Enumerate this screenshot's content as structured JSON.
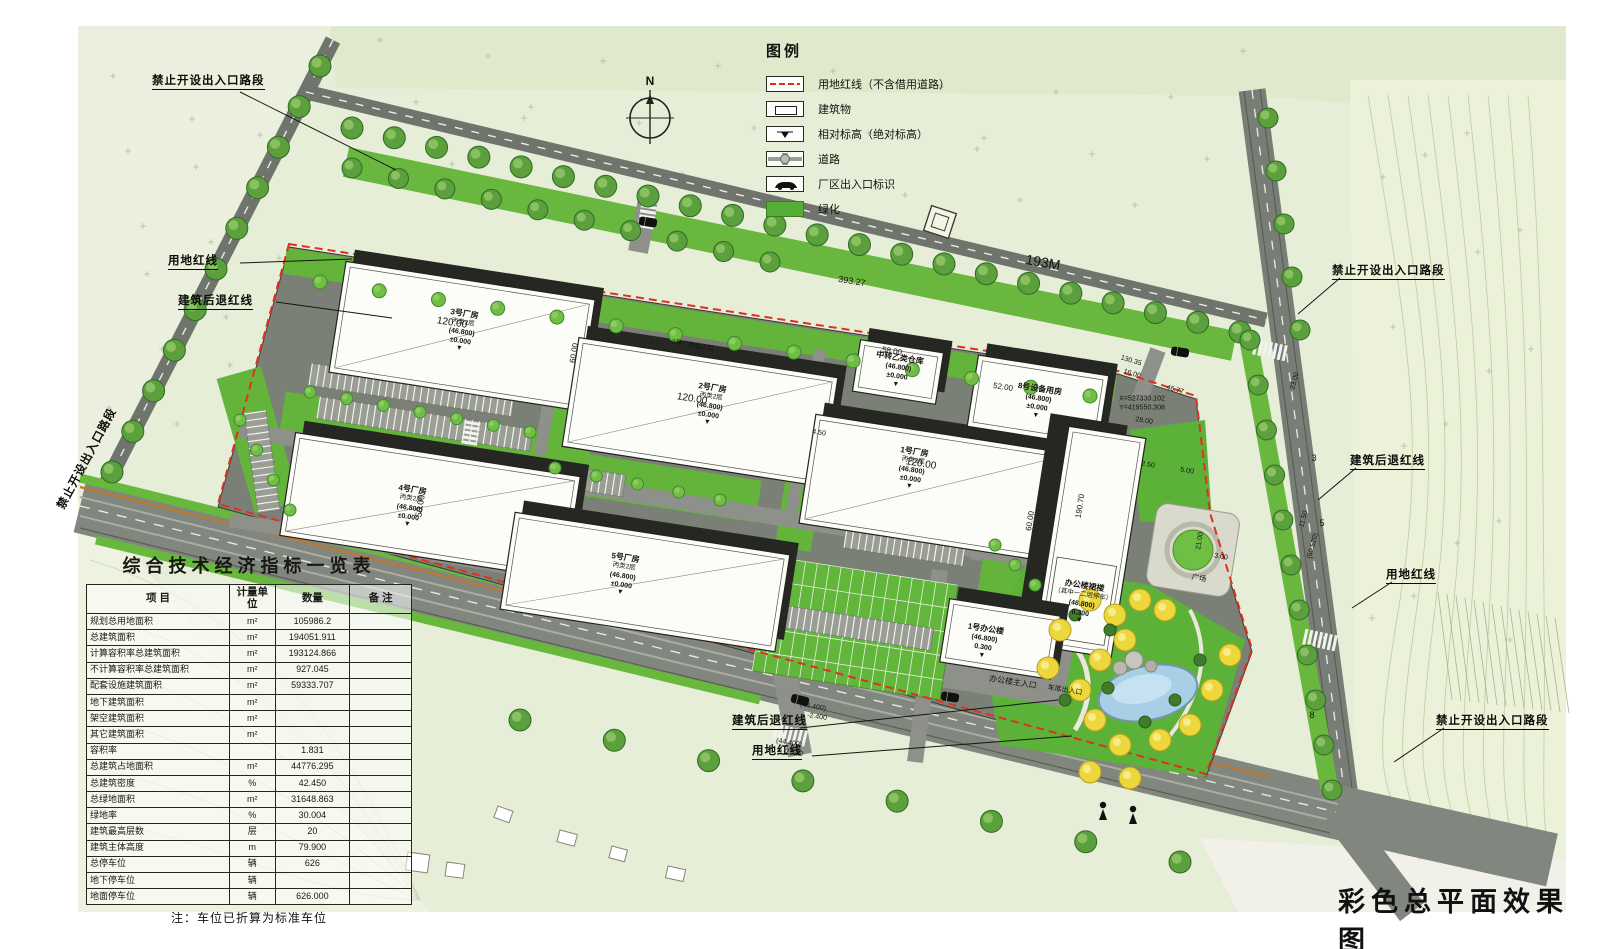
{
  "doc_title": "彩色总平面效果图",
  "compass": {
    "label": "N"
  },
  "legend": {
    "title": "图例",
    "items": [
      {
        "symbol": "red-dashed-line",
        "label": "用地红线（不含借用道路）"
      },
      {
        "symbol": "building-rect",
        "label": "建筑物"
      },
      {
        "symbol": "elevation-marker",
        "label": "相对标高（绝对标高）"
      },
      {
        "symbol": "road",
        "label": "道路"
      },
      {
        "symbol": "entrance-car",
        "label": "厂区出入口标识"
      },
      {
        "symbol": "green-fill",
        "label": "绿化"
      }
    ]
  },
  "table": {
    "title": "综合技术经济指标一览表",
    "headers": [
      "项    目",
      "计量单位",
      "数量",
      "备  注"
    ],
    "rows": [
      [
        "规划总用地面积",
        "m²",
        "105986.2",
        ""
      ],
      [
        "总建筑面积",
        "m²",
        "194051.911",
        ""
      ],
      [
        "计算容积率总建筑面积",
        "m²",
        "193124.866",
        ""
      ],
      [
        "不计算容积率总建筑面积",
        "m²",
        "927.045",
        ""
      ],
      [
        "配套设施建筑面积",
        "m²",
        "59333.707",
        ""
      ],
      [
        "地下建筑面积",
        "m²",
        "",
        ""
      ],
      [
        "架空建筑面积",
        "m²",
        "",
        ""
      ],
      [
        "其它建筑面积",
        "m²",
        "",
        ""
      ],
      [
        "容积率",
        "",
        "1.831",
        ""
      ],
      [
        "总建筑占地面积",
        "m²",
        "44776.295",
        ""
      ],
      [
        "总建筑密度",
        "%",
        "42.450",
        ""
      ],
      [
        "总绿地面积",
        "m²",
        "31648.863",
        ""
      ],
      [
        "绿地率",
        "%",
        "30.004",
        ""
      ],
      [
        "建筑最高层数",
        "层",
        "20",
        ""
      ],
      [
        "建筑主体高度",
        "m",
        "79.900",
        ""
      ],
      [
        "总停车位",
        "辆",
        "626",
        ""
      ],
      [
        "地下停车位",
        "辆",
        "",
        ""
      ],
      [
        "地面停车位",
        "辆",
        "626.000",
        ""
      ]
    ],
    "note": "注：车位已折算为标准车位"
  },
  "buildings": [
    {
      "name": "3号厂房",
      "cls": "丙类2层",
      "elev": "(46.800)",
      "lvl": "±0.000"
    },
    {
      "name": "2号厂房",
      "cls": "丙类2层",
      "elev": "(46.800)",
      "lvl": "±0.000"
    },
    {
      "name": "1号厂房",
      "cls": "丙类2层",
      "elev": "(46.800)",
      "lvl": "±0.000"
    },
    {
      "name": "4号厂房",
      "cls": "丙类2层",
      "elev": "(46.800)",
      "lvl": "±0.000"
    },
    {
      "name": "5号厂房",
      "cls": "丙类2层",
      "elev": "(46.800)",
      "lvl": "±0.000"
    },
    {
      "name": "8号设备用房",
      "cls": "",
      "elev": "(46.800)",
      "lvl": "±0.000"
    },
    {
      "name": "中转乙类仓库",
      "cls": "",
      "elev": "(46.800)",
      "lvl": "±0.000"
    },
    {
      "name": "办公楼裙楼",
      "cls": "（其中一二层停车）",
      "elev": "(46.800)",
      "lvl": "0.300"
    },
    {
      "name": "1号办公楼",
      "cls": "",
      "elev": "(46.800)",
      "lvl": "0.300"
    }
  ],
  "callouts": [
    {
      "text": "禁止开设出入口路段"
    },
    {
      "text": "用地红线"
    },
    {
      "text": "建筑后退红线"
    },
    {
      "text": "禁止开设出入口路段"
    },
    {
      "text": "建筑后退红线"
    },
    {
      "text": "用地红线"
    },
    {
      "text": "禁止开设出入口路段"
    },
    {
      "text": "建筑后退红线"
    },
    {
      "text": "用地红线"
    },
    {
      "text": "禁止开设出入口路段"
    }
  ],
  "annotations": [
    {
      "text": "393.27"
    },
    {
      "text": "193M"
    },
    {
      "text": "120.00"
    },
    {
      "text": "120.00"
    },
    {
      "text": "120.00"
    },
    {
      "text": "50.00"
    },
    {
      "text": "60.00"
    },
    {
      "text": "60.00"
    },
    {
      "text": "58.00"
    },
    {
      "text": "52.00"
    },
    {
      "text": "130.35"
    },
    {
      "text": "16.00"
    },
    {
      "text": "46.77"
    },
    {
      "text": "28.00"
    },
    {
      "text": "190.70"
    },
    {
      "text": "2.50"
    },
    {
      "text": "5.00"
    },
    {
      "text": "3.00"
    },
    {
      "text": "21.00"
    },
    {
      "text": "23.00"
    },
    {
      "text": "11.50"
    },
    {
      "text": "4.50"
    },
    {
      "text": "(50.520)"
    },
    {
      "text": "(44.400)"
    },
    {
      "text": "-2.400"
    },
    {
      "text": "(44.400)"
    },
    {
      "text": "-2.100"
    },
    {
      "text": "X=527330.102"
    },
    {
      "text": "Y=419550.308"
    },
    {
      "text": "3"
    },
    {
      "text": "5"
    },
    {
      "text": "8"
    },
    {
      "text": "广场"
    },
    {
      "text": "办公楼主入口"
    },
    {
      "text": "车库出入口"
    },
    {
      "text": "2号厂房出入口"
    }
  ]
}
